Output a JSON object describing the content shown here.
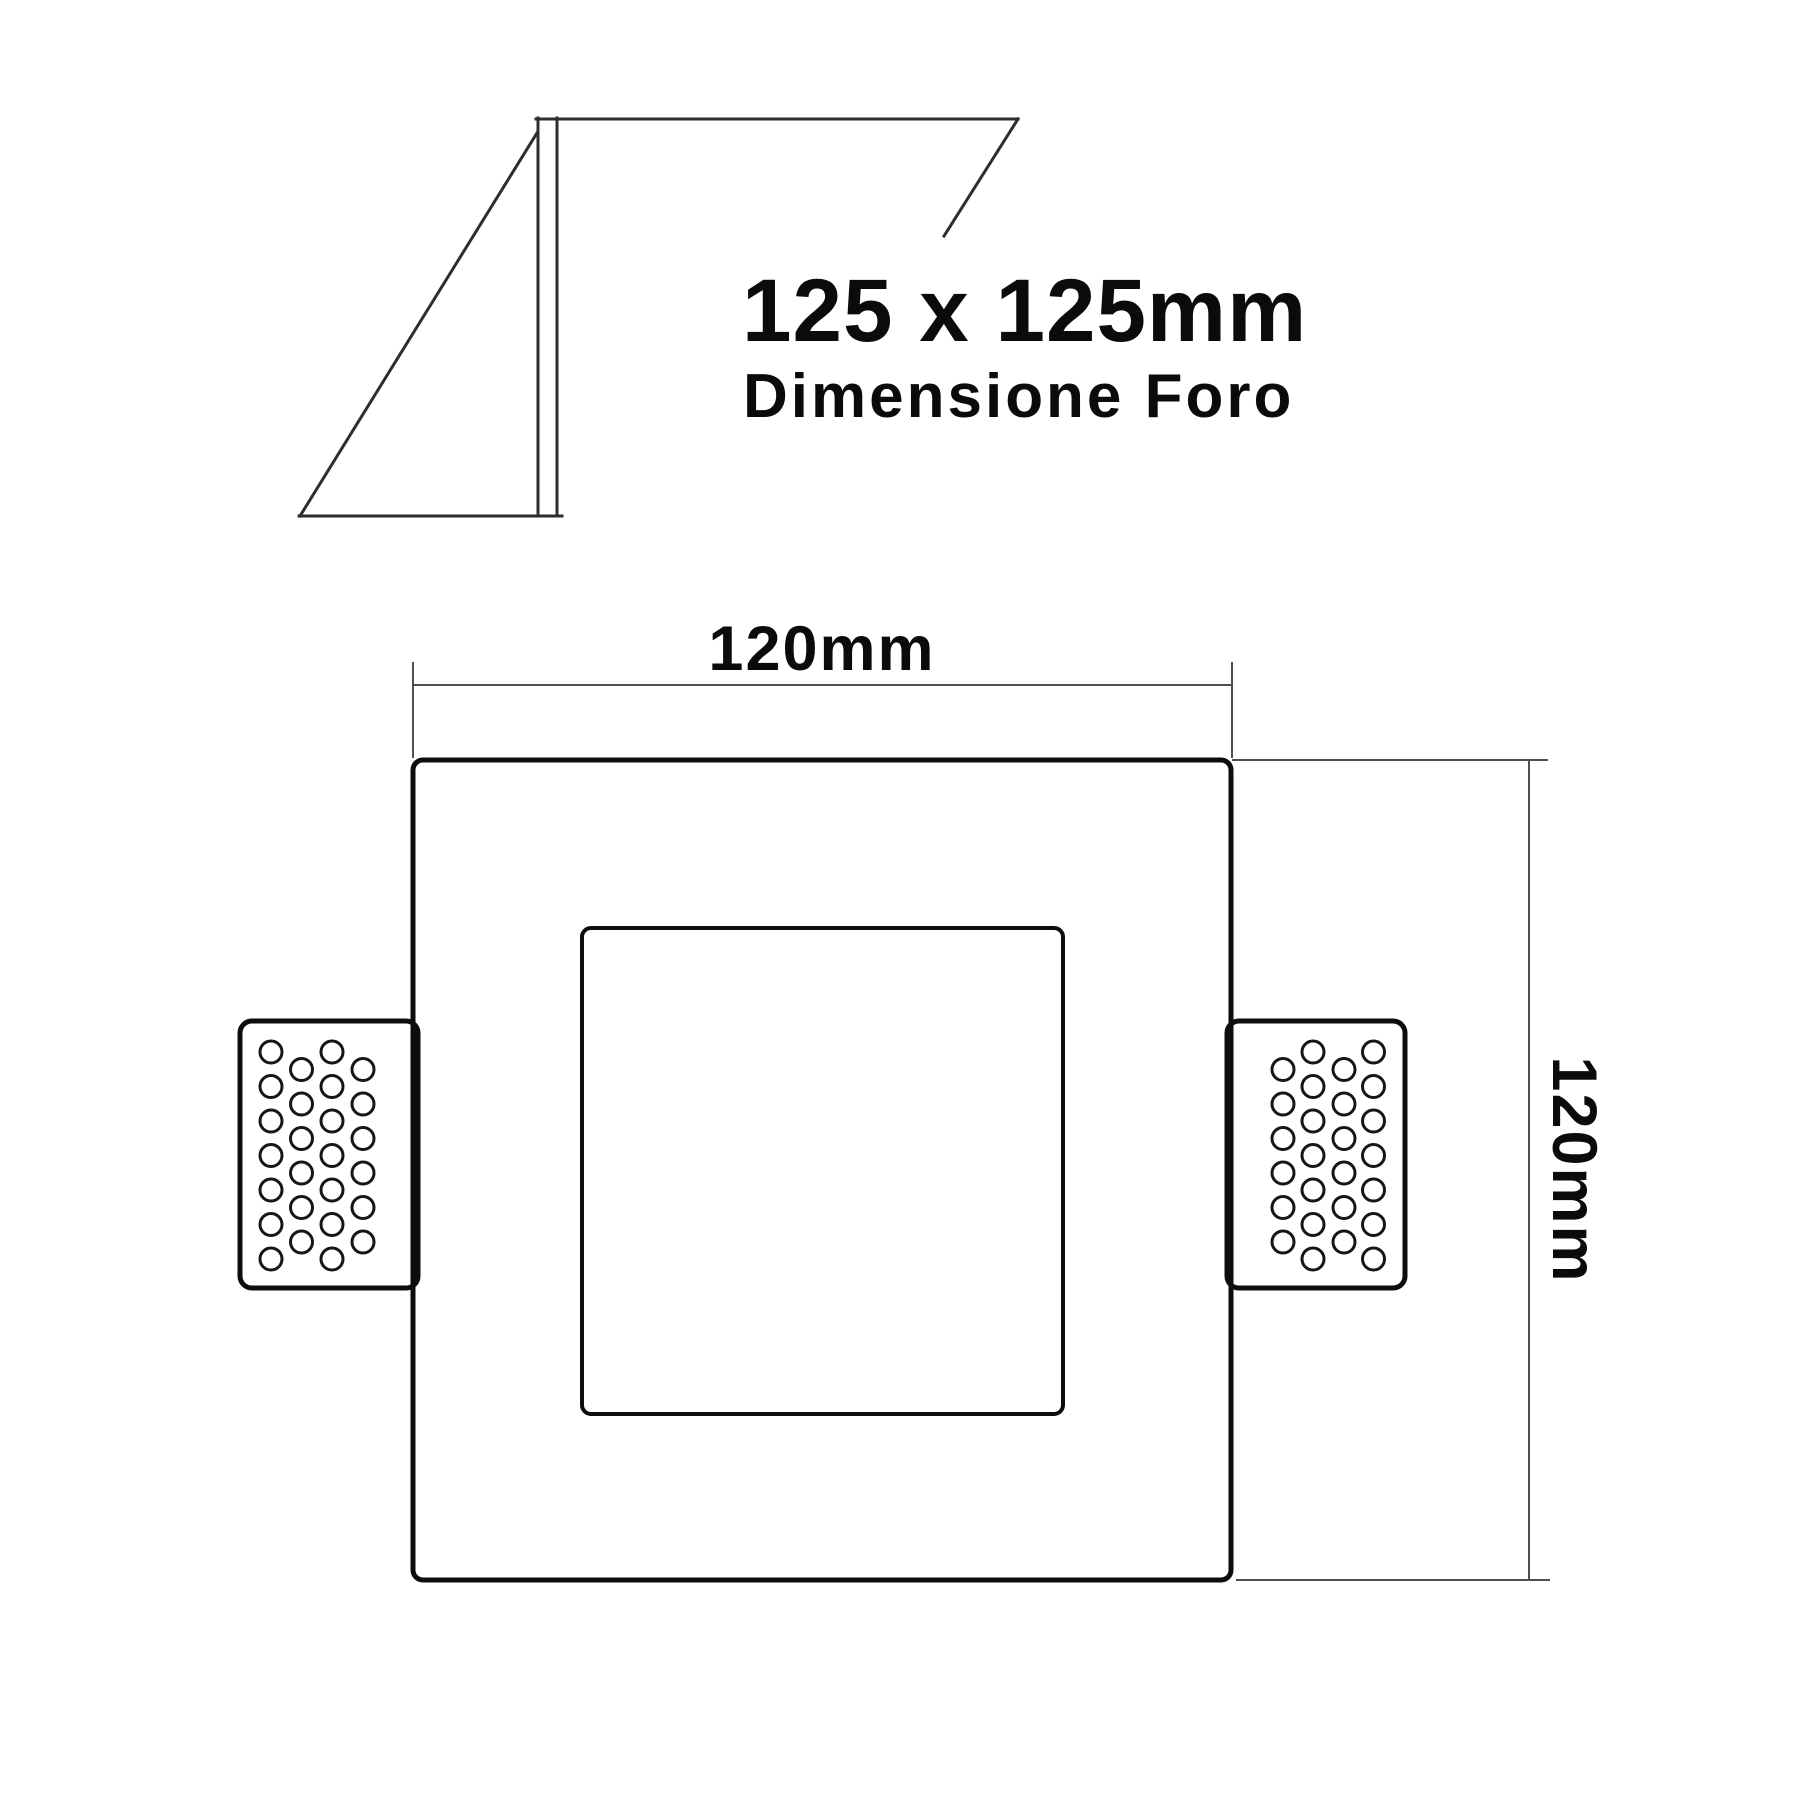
{
  "hole_note": {
    "size": "125 x 125mm",
    "caption": "Dimensione Foro"
  },
  "dimensions": {
    "top": "120mm",
    "right": "120mm"
  },
  "colors": {
    "background": "#ffffff",
    "ink": "#0d0d0d",
    "section_line": "#2e2e2e",
    "dimension_line": "#4f4f4f"
  },
  "perforation": {
    "circle_radius": 11,
    "row_step": 34.5,
    "left_columns": [
      {
        "x": 271,
        "count": 7,
        "start": 1052
      },
      {
        "x": 301.5,
        "count": 6,
        "start": 1069.5
      },
      {
        "x": 332,
        "count": 7,
        "start": 1052
      },
      {
        "x": 363,
        "count": 6,
        "start": 1069.5
      }
    ],
    "right_columns": [
      {
        "x": 1283,
        "count": 6,
        "start": 1069.5
      },
      {
        "x": 1313,
        "count": 7,
        "start": 1052
      },
      {
        "x": 1344,
        "count": 6,
        "start": 1069.5
      },
      {
        "x": 1373.5,
        "count": 7,
        "start": 1052
      }
    ]
  }
}
